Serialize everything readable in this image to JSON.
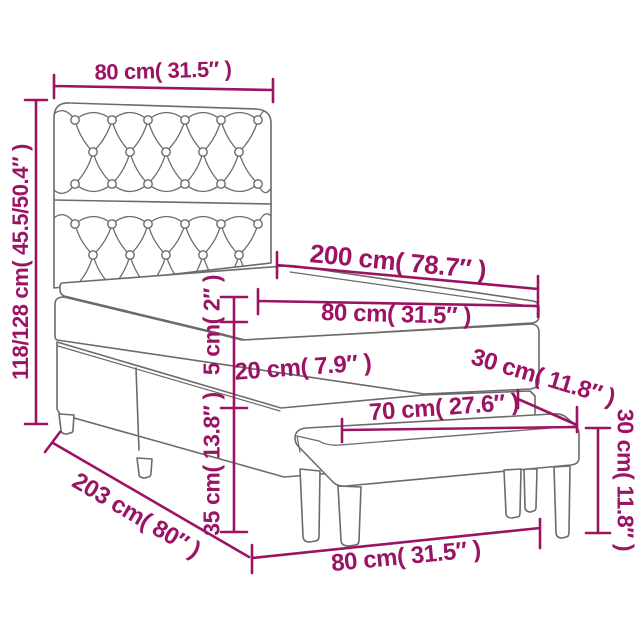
{
  "diagram": {
    "subject": "box spring bed with tufted headboard, mattress topper and bench - dimension diagram",
    "colors": {
      "dimension_accent": "#9b1464",
      "furniture_outline": "#6b6b6b",
      "background": "#ffffff"
    },
    "dimensions": {
      "headboard_width": "80 cm( 31.5″ )",
      "headboard_height": "118/128 cm( 45.5/50.4″ )",
      "bed_length": "200 cm( 78.7″ )",
      "bed_width": "80 cm( 31.5″ )",
      "topper_height": "5 cm( 2″ )",
      "mattress_height": "20 cm( 7.9″ )",
      "base_height": "35 cm( 13.8″ )",
      "total_length": "203 cm( 80″ )",
      "bench_depth": "30 cm( 11.8″ )",
      "bench_length": "70 cm( 27.6″ )",
      "bench_height": "30 cm( 11.8″ )",
      "bench_width": "80 cm( 31.5″ )"
    }
  }
}
